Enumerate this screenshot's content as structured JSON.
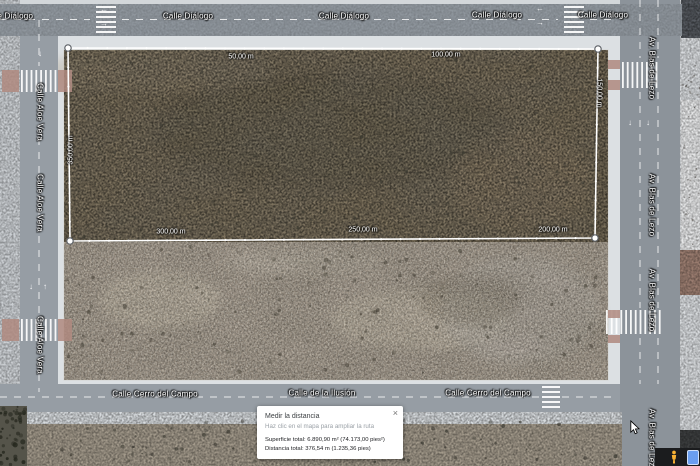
{
  "streets": {
    "calle_dialogo": "Calle Diálogo",
    "calle_aloe_vera": "Calle Aloe Vera",
    "av_blas_de_lezo": "Av. Blas de Lezo",
    "calle_cerro_del_campo": "Calle Cerro del Campo",
    "calle_de_la_ilusion": "Calle de la Ilusión"
  },
  "measure": {
    "path_px": [
      [
        68,
        48
      ],
      [
        598,
        49
      ],
      [
        595,
        238
      ],
      [
        70,
        241
      ]
    ],
    "closed": true,
    "labels": [
      {
        "text": "50,00 m",
        "x": 241,
        "y": 57,
        "rot": 0
      },
      {
        "text": "100,00 m",
        "x": 446,
        "y": 55,
        "rot": 0
      },
      {
        "text": "150,00 m",
        "x": 599,
        "y": 93,
        "rot": 90
      },
      {
        "text": "200,00 m",
        "x": 553,
        "y": 230,
        "rot": 0
      },
      {
        "text": "250,00 m",
        "x": 363,
        "y": 230,
        "rot": 0
      },
      {
        "text": "300,00 m",
        "x": 171,
        "y": 232,
        "rot": 0
      },
      {
        "text": "350,00 m",
        "x": 71,
        "y": 150,
        "rot": -90
      }
    ]
  },
  "popup": {
    "title": "Medir la distancia",
    "hint": "Haz clic en el mapa para ampliar la ruta",
    "surface_line": "Superficie total: 6.890,90 m² (74.173,00 pies²)",
    "distance_line": "Distancia total: 376,54 m (1.235,36 pies)",
    "close_icon": "×"
  },
  "arrows": {
    "left": "←",
    "right": "→",
    "up": "↑",
    "down": "↓"
  },
  "colors": {
    "measure_line": "#ffffff",
    "road_asphalt": "#8f969d",
    "sidewalk": "#dce0e3",
    "dirt_upper": "#7d7058",
    "dirt_lower": "#a2978a",
    "crosswalk_red": "#b08a80",
    "pegman_yellow": "#f9b234",
    "minimap_blue": "#6a9ef0"
  }
}
